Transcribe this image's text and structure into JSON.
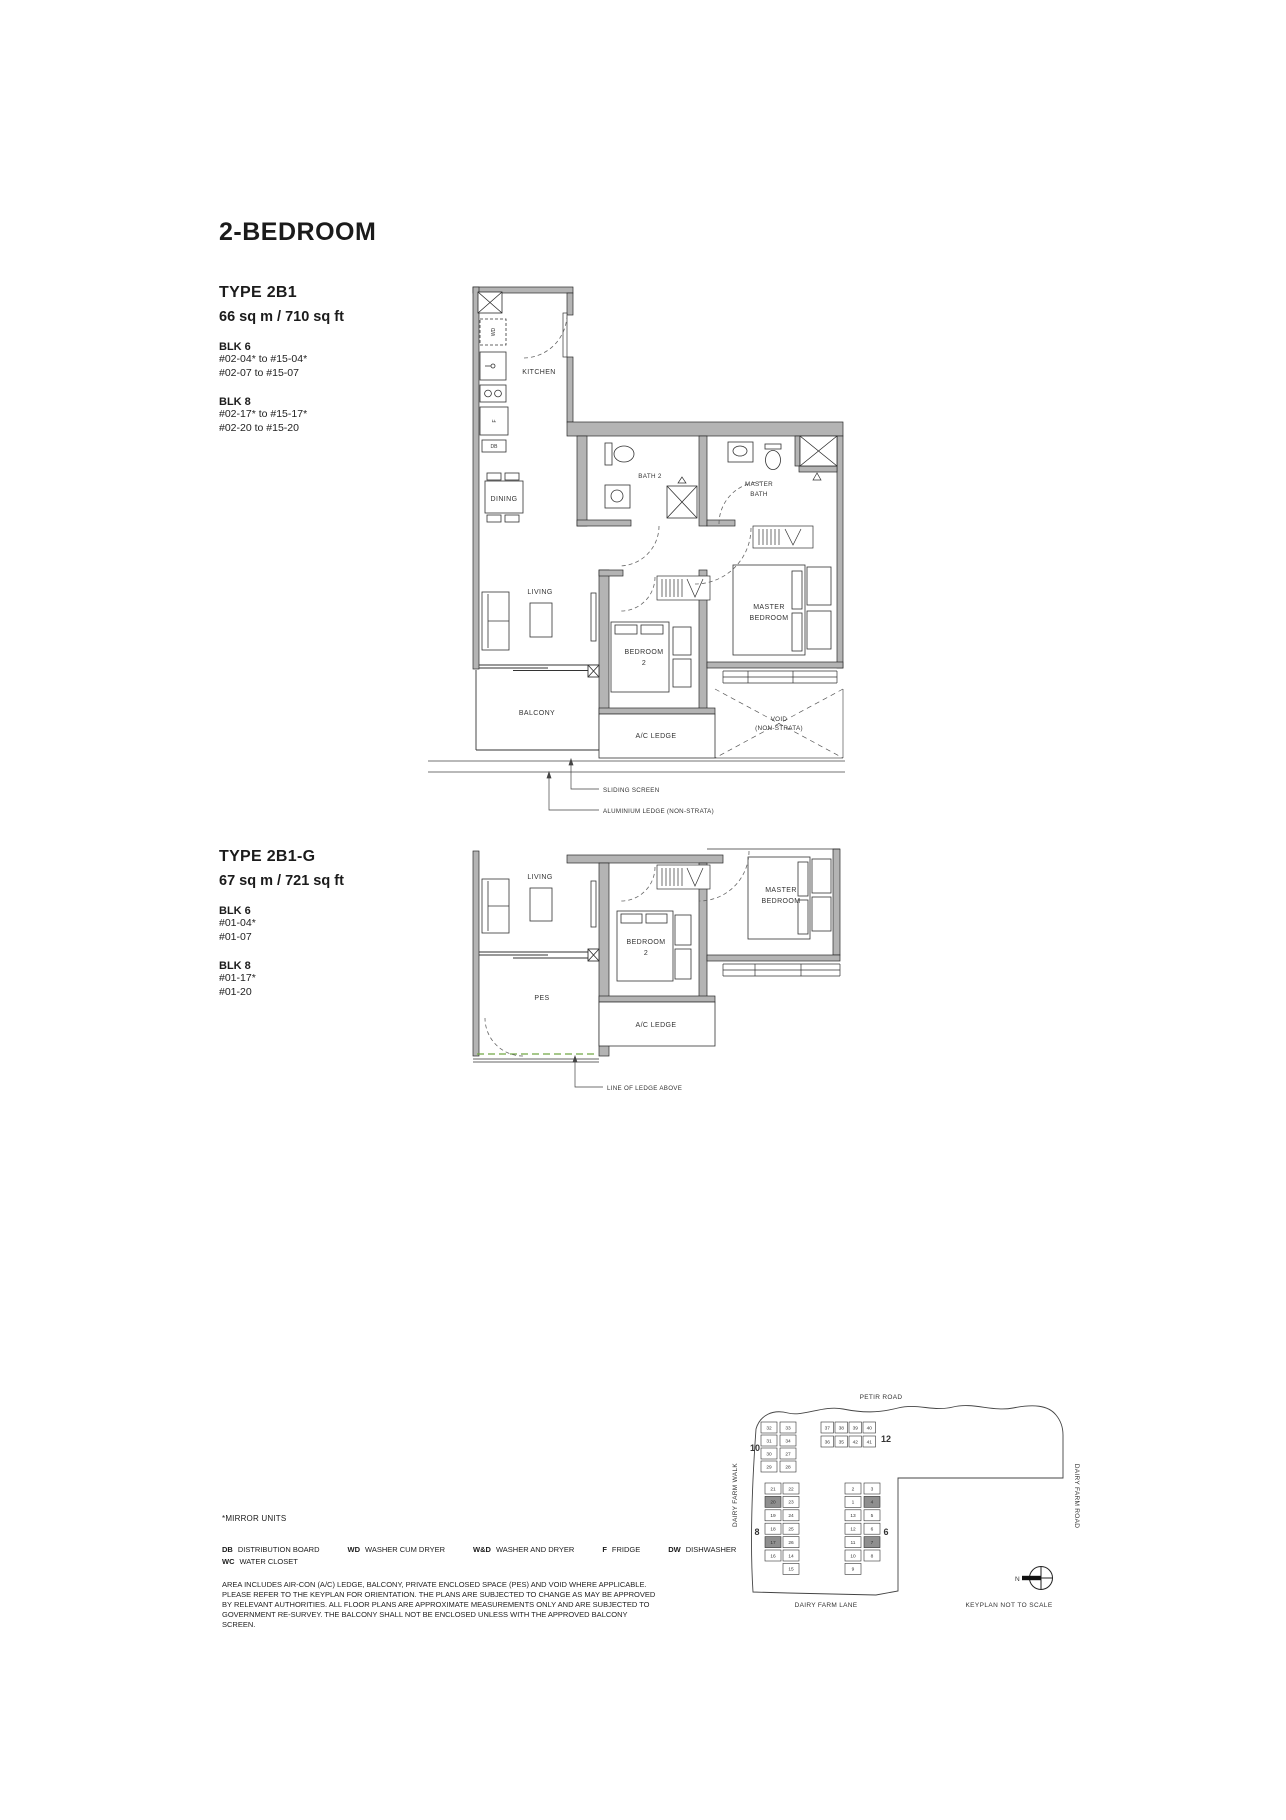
{
  "page": {
    "title": "2-BEDROOM"
  },
  "types": [
    {
      "name": "TYPE 2B1",
      "area": "66 sq m / 710 sq ft",
      "blocks": [
        {
          "name": "BLK 6",
          "units": [
            "#02-04* to #15-04*",
            "#02-07  to #15-07"
          ]
        },
        {
          "name": "BLK 8",
          "units": [
            "#02-17* to #15-17*",
            "#02-20  to #15-20"
          ]
        }
      ]
    },
    {
      "name": "TYPE 2B1-G",
      "area": "67 sq m / 721 sq ft",
      "blocks": [
        {
          "name": "BLK 6",
          "units": [
            "#01-04*",
            "#01-07"
          ]
        },
        {
          "name": "BLK 8",
          "units": [
            "#01-17*",
            "#01-20"
          ]
        }
      ]
    }
  ],
  "plan1": {
    "labels": {
      "kitchen": "KITCHEN",
      "dining": "DINING",
      "living": "LIVING",
      "balcony": "BALCONY",
      "bath2": "BATH 2",
      "master_bath_l1": "MASTER",
      "master_bath_l2": "BATH",
      "bedroom2_l1": "BEDROOM",
      "bedroom2_l2": "2",
      "master_bedroom_l1": "MASTER",
      "master_bedroom_l2": "BEDROOM",
      "ac_ledge": "A/C LEDGE",
      "void_l1": "VOID",
      "void_l2": "(NON-STRATA)",
      "wd": "WD",
      "f": "F",
      "db": "DB"
    },
    "annotations": {
      "sliding_screen": "SLIDING SCREEN",
      "aluminium_ledge": "ALUMINIUM LEDGE (NON-STRATA)"
    }
  },
  "plan2": {
    "labels": {
      "living": "LIVING",
      "pes": "PES",
      "bedroom2_l1": "BEDROOM",
      "bedroom2_l2": "2",
      "master_bedroom_l1": "MASTER",
      "master_bedroom_l2": "BEDROOM",
      "ac_ledge": "A/C LEDGE"
    },
    "annotations": {
      "line_of_ledge": "LINE OF LEDGE ABOVE"
    }
  },
  "legend": {
    "mirror_note": "*MIRROR UNITS",
    "items": [
      {
        "abbr": "DB",
        "label": "DISTRIBUTION BOARD"
      },
      {
        "abbr": "WD",
        "label": "WASHER CUM DRYER"
      },
      {
        "abbr": "W&D",
        "label": "WASHER AND DRYER"
      },
      {
        "abbr": "F",
        "label": "FRIDGE"
      },
      {
        "abbr": "DW",
        "label": "DISHWASHER"
      },
      {
        "abbr": "WC",
        "label": "WATER CLOSET"
      }
    ],
    "disclaimer": "AREA INCLUDES AIR-CON (A/C) LEDGE, BALCONY, PRIVATE ENCLOSED SPACE (PES) AND VOID WHERE APPLICABLE. PLEASE REFER TO THE KEYPLAN FOR ORIENTATION. THE PLANS ARE SUBJECTED TO CHANGE AS MAY BE APPROVED BY RELEVANT AUTHORITIES. ALL FLOOR PLANS ARE APPROXIMATE MEASUREMENTS ONLY AND ARE SUBJECTED TO GOVERNMENT RE-SURVEY. THE BALCONY SHALL NOT BE ENCLOSED UNLESS WITH THE APPROVED BALCONY SCREEN."
  },
  "keyplan": {
    "roads": {
      "top": "PETIR ROAD",
      "left": "DAIRY FARM WALK",
      "right": "DAIRY FARM ROAD",
      "bottom": "DAIRY FARM LANE"
    },
    "note": "KEYPLAN NOT TO SCALE",
    "north": "N",
    "highlight_color": "#8f8f8f",
    "blocks": [
      {
        "id": "b10",
        "label": "10",
        "col1": [
          "32",
          "31",
          "30",
          "29"
        ],
        "col2": [
          "33",
          "34",
          "27",
          "28"
        ],
        "highlight": []
      },
      {
        "id": "b12",
        "label": "12",
        "col1": [
          "37",
          "38",
          "39",
          "40"
        ],
        "col2": [
          "36",
          "35",
          "42",
          "41"
        ],
        "highlight": []
      },
      {
        "id": "b8",
        "label": "8",
        "col1": [
          "21",
          "20",
          "19",
          "18",
          "17",
          "16"
        ],
        "col2": [
          "22",
          "23",
          "24",
          "25",
          "26",
          "14",
          "15"
        ],
        "highlight": [
          "20",
          "17"
        ]
      },
      {
        "id": "b6",
        "label": "6",
        "col1": [
          "2",
          "1",
          "13",
          "12",
          "11",
          "10",
          "9"
        ],
        "col2": [
          "3",
          "4",
          "5",
          "6",
          "7",
          "8"
        ],
        "highlight": [
          "4",
          "7"
        ]
      }
    ]
  }
}
